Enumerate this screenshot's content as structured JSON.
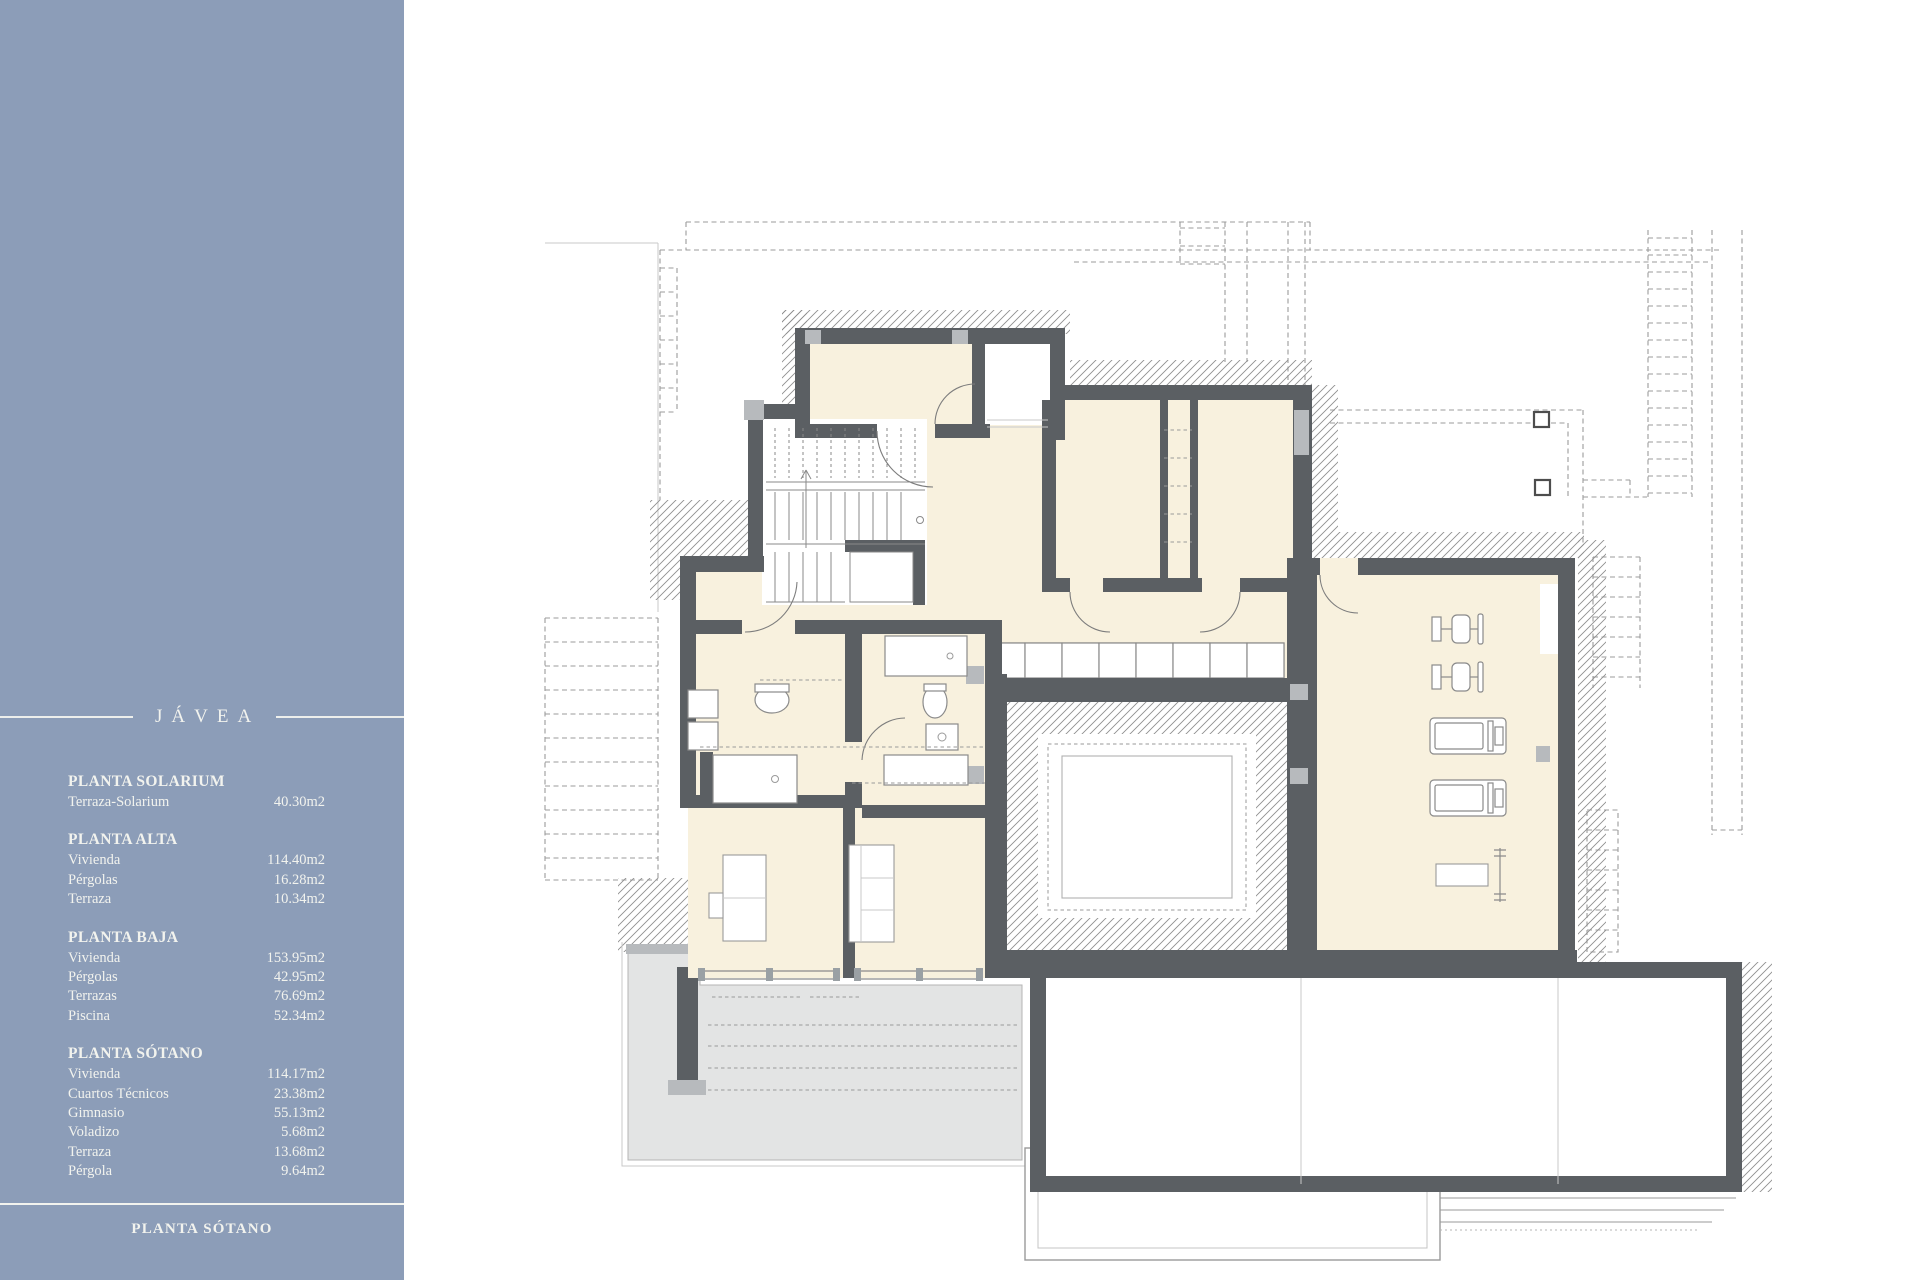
{
  "colors": {
    "sidebar_bg": "#8c9db8",
    "sidebar_text": "#f2f3ee",
    "wall": "#5b5f63",
    "room_fill": "#f8f1de",
    "column": "#b7babd",
    "hatch_line": "#8f8f8f",
    "driveway": "#e3e4e4",
    "projection_dash": "#9b9b9b"
  },
  "sidebar": {
    "brand": "JÁVEA",
    "sections": [
      {
        "title": "PLANTA SOLARIUM",
        "rows": [
          {
            "label": "Terraza-Solarium",
            "value": "40.30m2"
          }
        ]
      },
      {
        "title": "PLANTA ALTA",
        "rows": [
          {
            "label": "Vivienda",
            "value": "114.40m2"
          },
          {
            "label": "Pérgolas",
            "value": "16.28m2"
          },
          {
            "label": "Terraza",
            "value": "10.34m2"
          }
        ]
      },
      {
        "title": "PLANTA BAJA",
        "rows": [
          {
            "label": "Vivienda",
            "value": "153.95m2"
          },
          {
            "label": "Pérgolas",
            "value": "42.95m2"
          },
          {
            "label": "Terrazas",
            "value": "76.69m2"
          },
          {
            "label": "Piscina",
            "value": "52.34m2"
          }
        ]
      },
      {
        "title": "PLANTA SÓTANO",
        "rows": [
          {
            "label": "Vivienda",
            "value": "114.17m2"
          },
          {
            "label": "Cuartos Técnicos",
            "value": "23.38m2"
          },
          {
            "label": "Gimnasio",
            "value": "55.13m2"
          },
          {
            "label": "Voladizo",
            "value": "5.68m2"
          },
          {
            "label": "Terraza",
            "value": "13.68m2"
          },
          {
            "label": "Pérgola",
            "value": "9.64m2"
          }
        ]
      }
    ],
    "footer_label": "PLANTA SÓTANO"
  }
}
